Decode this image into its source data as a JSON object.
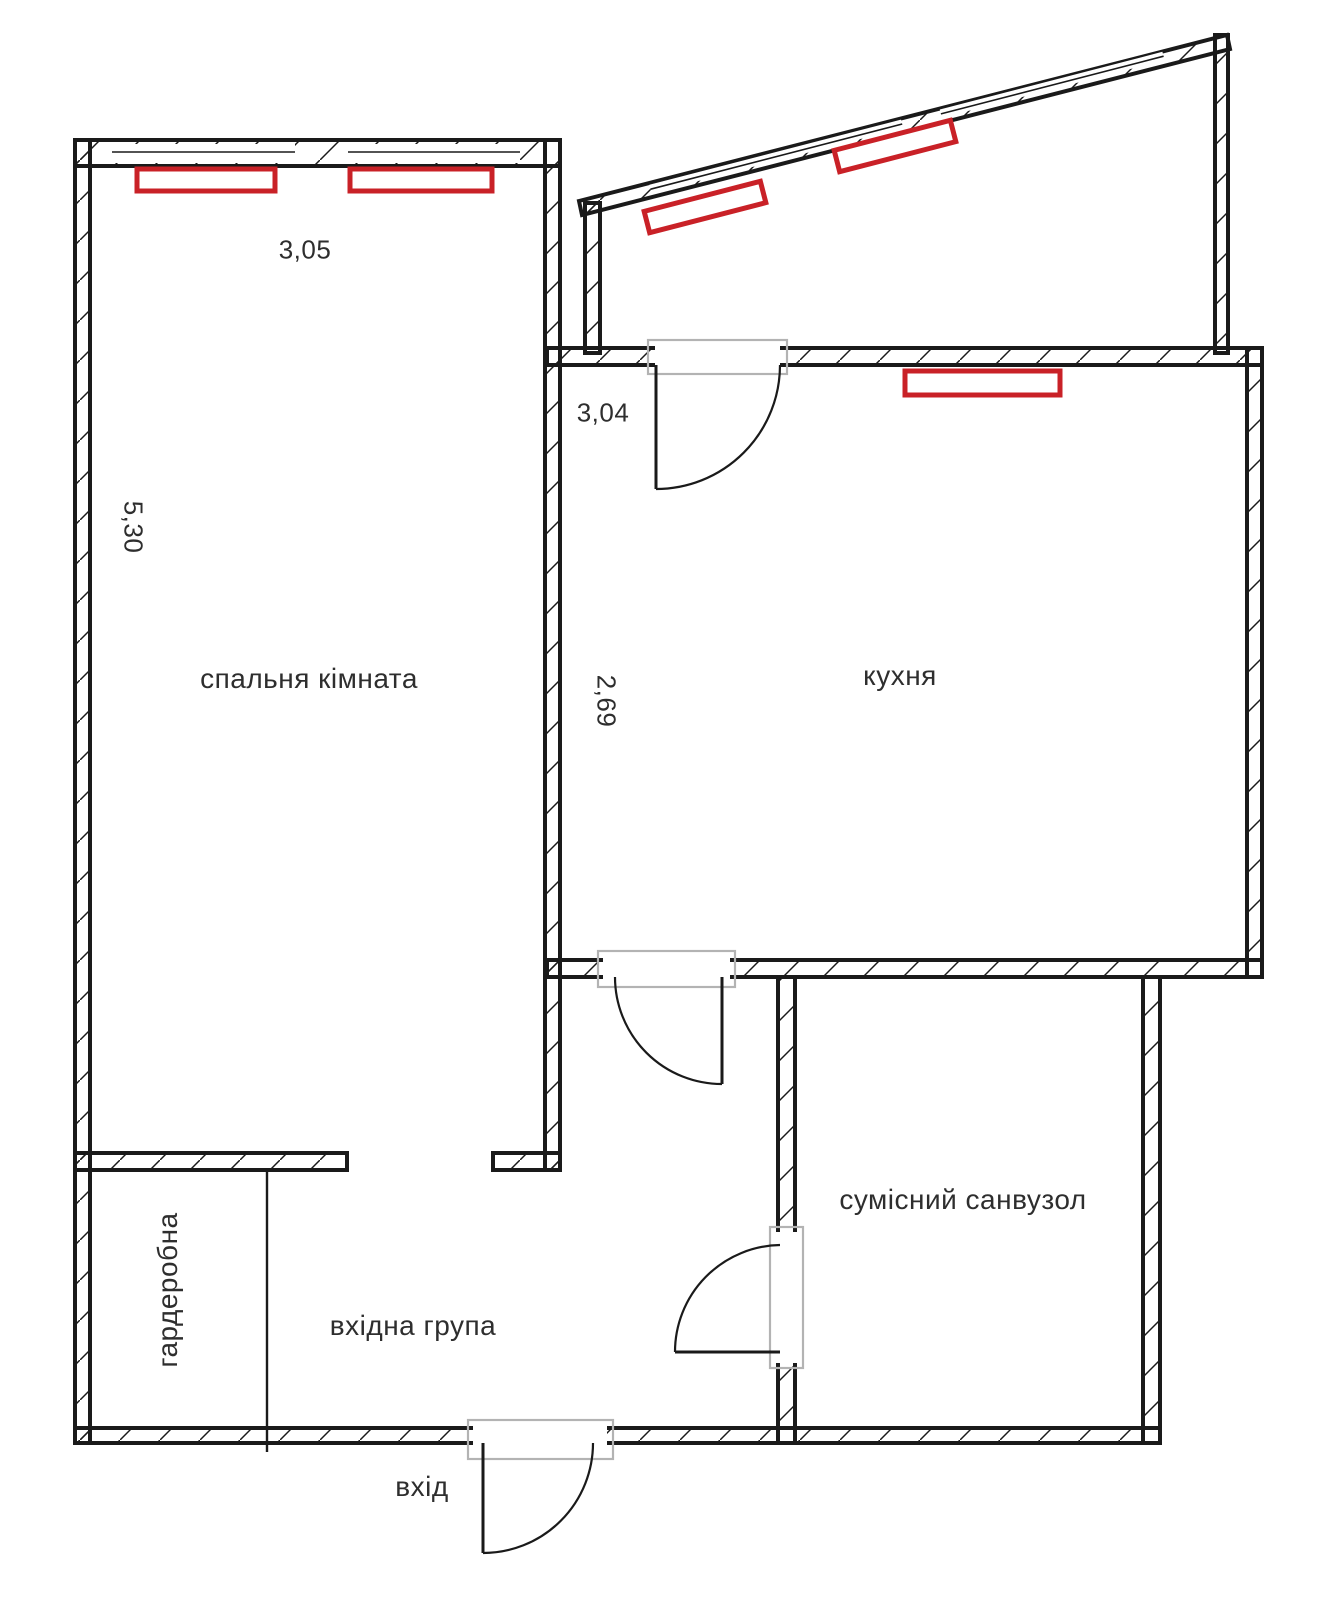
{
  "rooms": {
    "bedroom": {
      "label": "спальня кімната"
    },
    "kitchen": {
      "label": "кухня"
    },
    "bathroom": {
      "label": "сумісний санвузол"
    },
    "wardrobe": {
      "label": "гардеробна"
    },
    "hall": {
      "label": "вхідна група"
    }
  },
  "dimensions": {
    "bedroom_width": "3,05",
    "bedroom_length": "5,30",
    "kitchen_width": "3,04",
    "kitchen_depth": "2,69"
  },
  "labels": {
    "entrance": "вхід"
  },
  "colors": {
    "wall": "#1a1a1a",
    "radiator": "#c92127",
    "door_frame": "#b3b3b3",
    "text": "#2e2e2e",
    "background": "#ffffff"
  }
}
